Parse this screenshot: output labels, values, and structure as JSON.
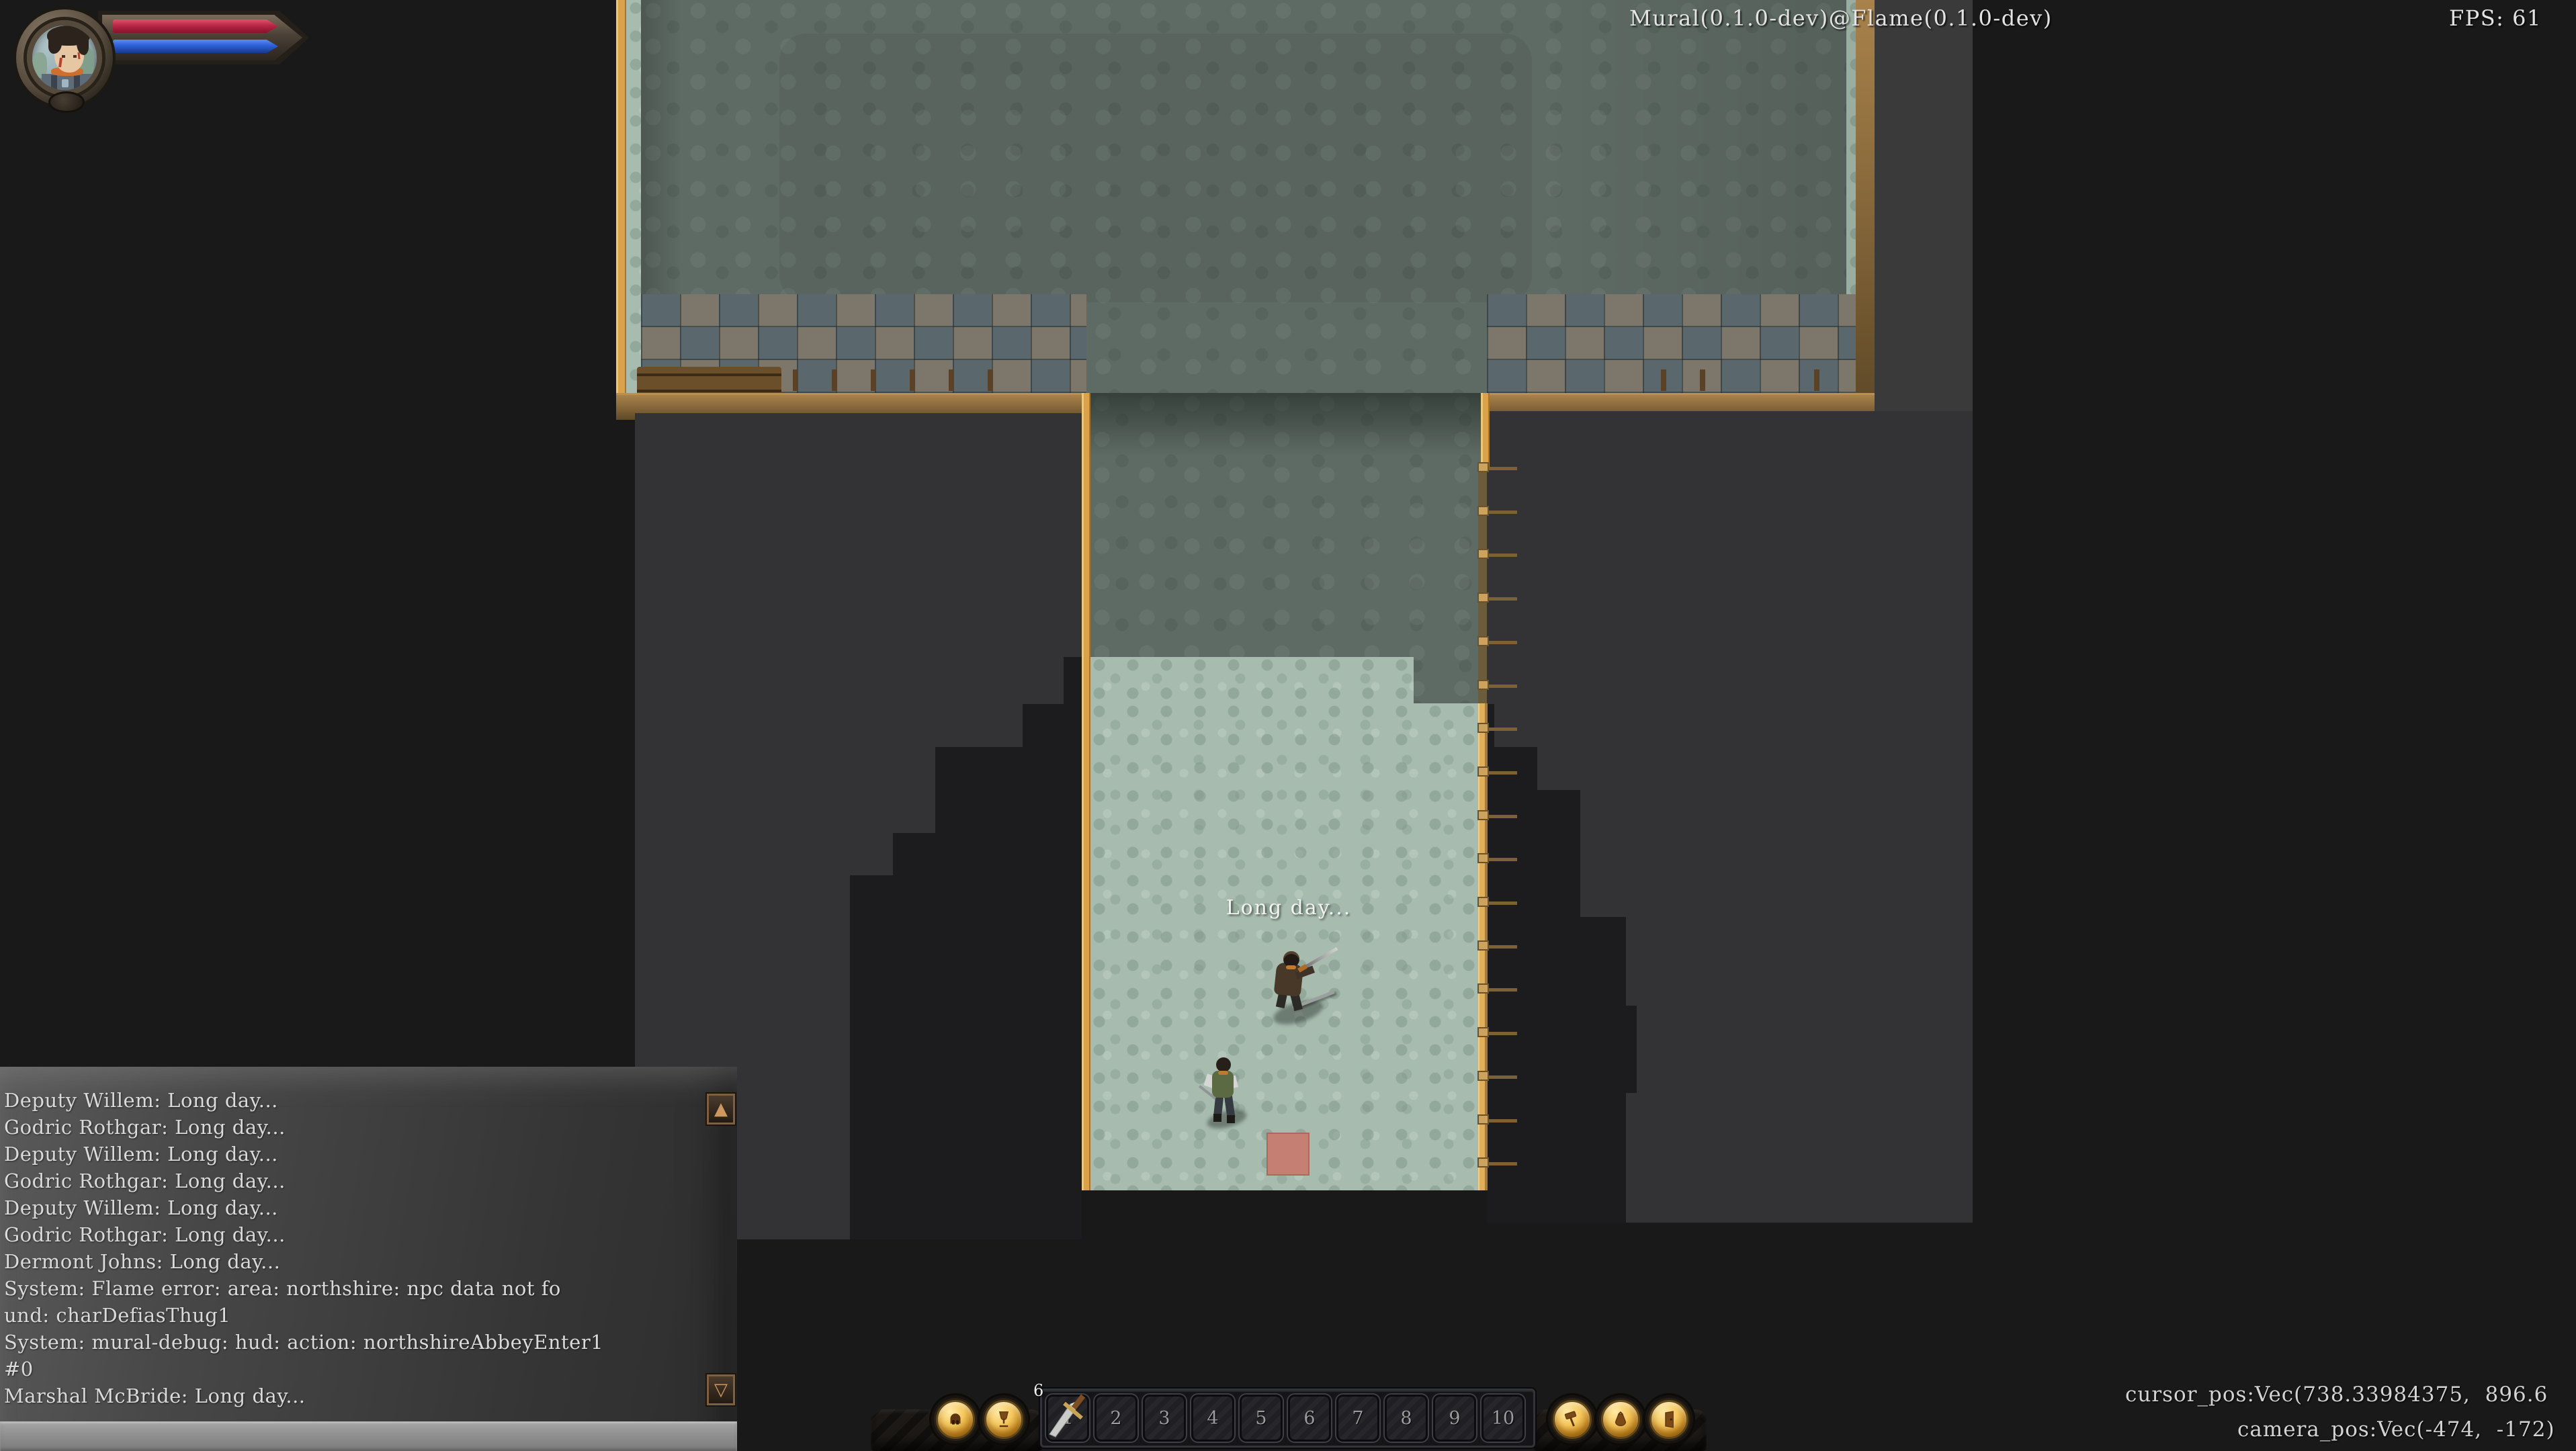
{
  "window": {
    "title_text": "Mural(0.1.0-dev)@Flame(0.1.0-dev)",
    "fps_text": "FPS: 61"
  },
  "debug": {
    "cursor_line": "cursor_pos:Vec(738.33984375,  896.6",
    "camera_line": "camera_pos:Vec(-474,  -172)"
  },
  "world": {
    "speech_text": "Long day...",
    "npcs": [
      {
        "name": "swordsman-npc"
      },
      {
        "name": "villager-npc"
      }
    ],
    "highlight_tile_color": "#c58073"
  },
  "chat": {
    "lines": [
      "Deputy Willem: Long day...",
      "Godric Rothgar: Long day...",
      "Deputy Willem: Long day...",
      "Godric Rothgar: Long day...",
      "Deputy Willem: Long day...",
      "Godric Rothgar: Long day...",
      "Dermont Johns: Long day...",
      "System: Flame error: area: northshire: npc data not fo",
      "und: charDefiasThug1",
      "System: mural-debug: hud: action: northshireAbbeyEnter1",
      "#0",
      "Marshal McBride: Long day..."
    ],
    "scroll_up_glyph": "▲",
    "scroll_down_glyph": "▽"
  },
  "action_bar": {
    "stack_count": "6",
    "slot_numbers": [
      "1",
      "2",
      "3",
      "4",
      "5",
      "6",
      "7",
      "8",
      "9",
      "10"
    ],
    "left_buttons": [
      "character",
      "goblet"
    ],
    "right_buttons": [
      "hammer",
      "bag",
      "door"
    ]
  },
  "status_bars": {
    "health_color": "#b82746",
    "mana_color": "#2d5fd6"
  },
  "palette": {
    "floor_dark": "#5e6a64",
    "floor_light": "#a7bcaf",
    "accent_wood": "#d9a24b",
    "room_shadow": "#333335"
  }
}
